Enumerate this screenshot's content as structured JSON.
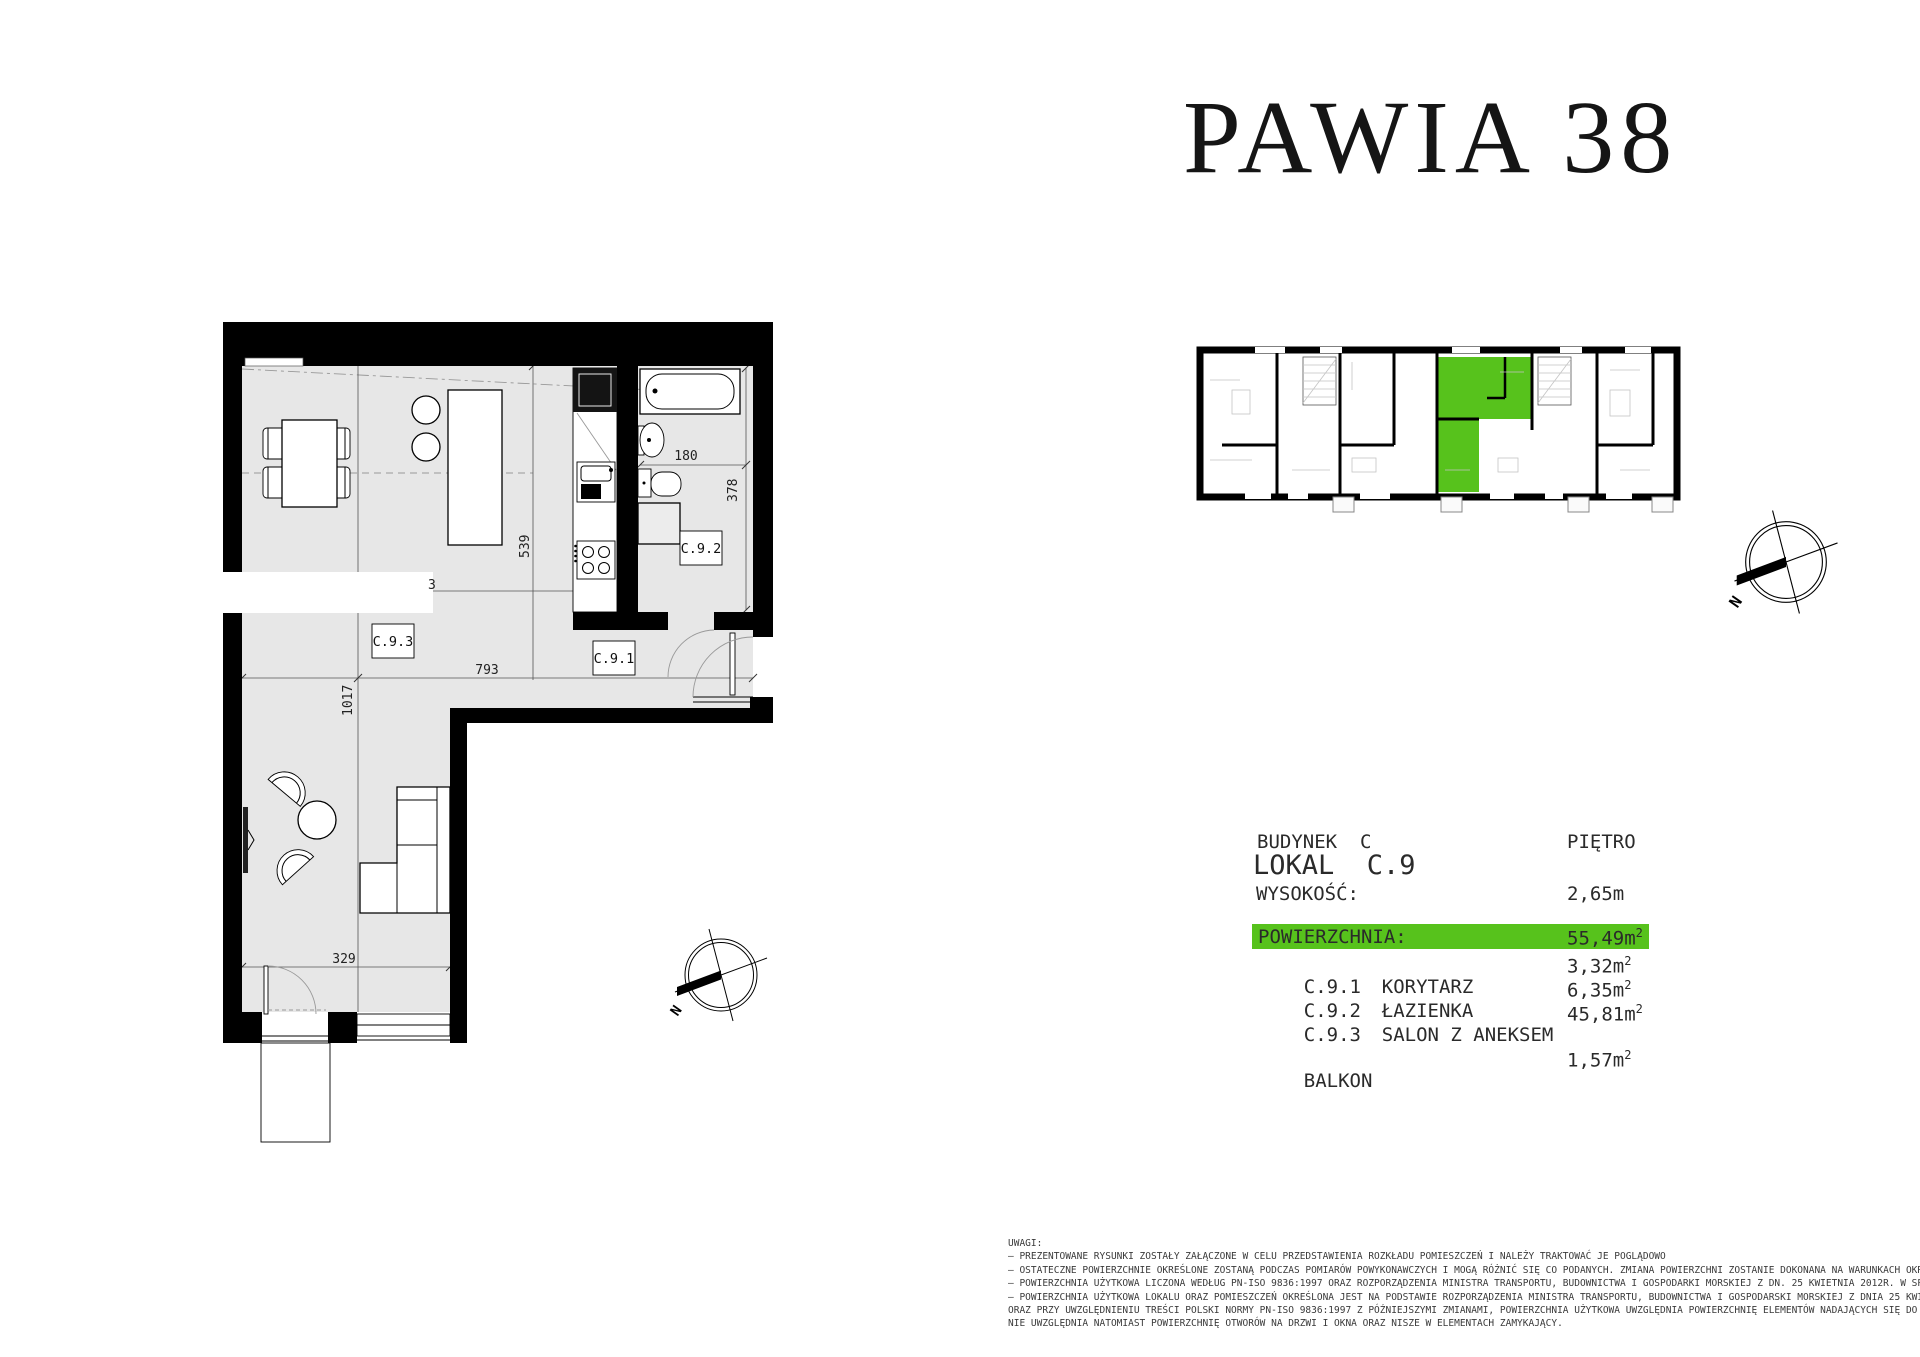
{
  "title": "PAWIA 38",
  "info": {
    "building_label": "BUDYNEK  C",
    "floor_label": "PIĘTRO",
    "unit_label": "LOKAL  C.9",
    "height_label": "WYSOKOŚĆ:",
    "height_value": "2,65m",
    "area_label": "POWIERZCHNIA:",
    "area_value": "55,49m",
    "rooms": [
      {
        "code": "C.9.1",
        "name": "KORYTARZ",
        "area": "3,32m"
      },
      {
        "code": "C.9.2",
        "name": "ŁAZIENKA",
        "area": "6,35m"
      },
      {
        "code": "C.9.3",
        "name": "SALON Z ANEKSEM",
        "area": "45,81m"
      }
    ],
    "balcony_label": "BALKON",
    "balcony_value": "1,57m",
    "sup": "2"
  },
  "plan": {
    "labels": {
      "hall": "C.9.1",
      "bath": "C.9.2",
      "salon": "C.9.3"
    },
    "dims": {
      "bath_width": "180",
      "bath_depth": "378",
      "kitchen_depth": "539",
      "salon_width": "793",
      "total_depth": "1017",
      "lower_width": "329",
      "covered_remnant": "3"
    },
    "north_letter": "N"
  },
  "notes": {
    "heading": "UWAGI:",
    "lines": [
      "– PREZENTOWANE RYSUNKI ZOSTAŁY ZAŁĄCZONE W CELU PRZEDSTAWIENIA ROZKŁADU POMIESZCZEŃ I NALEŻY TRAKTOWAĆ JE POGLĄDOWO",
      "– OSTATECZNE POWIERZCHNIE OKREŚLONE ZOSTANĄ PODCZAS POMIARÓW POWYKONAWCZYCH I MOGĄ RÓŻNIĆ SIĘ CO PODANYCH. ZMIANA POWIERZCHNI ZOSTANIE DOKONANA NA WARUNKACH OKREŚLONYCH W UMOWIE DEWELOPERSKIEJ",
      "– POWIERZCHNIA UŻYTKOWA LICZONA WEDŁUG PN-ISO 9836:1997 ORAZ ROZPORZĄDZENIA MINISTRA TRANSPORTU, BUDOWNICTWA I GOSPODARKI MORSKIEJ Z DN. 25 KWIETNIA 2012R. W SPRAWIE SZCZEGÓŁOWEGO ZAKRESU I FORMY PROJEKTU BUDOWLANEGO",
      "– POWIERZCHNIA UŻYTKOWA LOKALU ORAZ POMIESZCZEŃ OKREŚLONA JEST NA PODSTAWIE ROZPORZĄDZENIA MINISTRA TRANSPORTU, BUDOWNICTWA I GOSPODARSKI MORSKIEJ Z DNIA 25 KWIETNIA 2012R. W SPRAWIE SZCZEGÓŁOWEGO ZAKRESU I FORMY PROJEKTU BUDOWLANEGO",
      "ORAZ PRZY UWZGLĘDNIENIU TREŚCI POLSKI NORMY PN-ISO 9836:1997 Z PÓŹNIEJSZYMI ZMIANAMI, POWIERZCHNIA UŻYTKOWA UWZGLĘDNIA POWIERZCHNIĘ ELEMENTÓW NADAJĄCYCH SIĘ DO DEMONTAŻU I ROZBIÓRKI (RURY, KANAŁY I ŚCIANKI DZIAŁOWE),",
      "NIE UWZGLĘDNIA NATOMIAST POWIERZCHNIĘ OTWORÓW NA DRZWI I OKNA ORAZ NISZE W ELEMENTACH ZAMYKAJĄCY."
    ]
  },
  "colors": {
    "highlight_green": "#57c21c",
    "floor_gray": "#e7e7e7",
    "wall_black": "#000000"
  }
}
